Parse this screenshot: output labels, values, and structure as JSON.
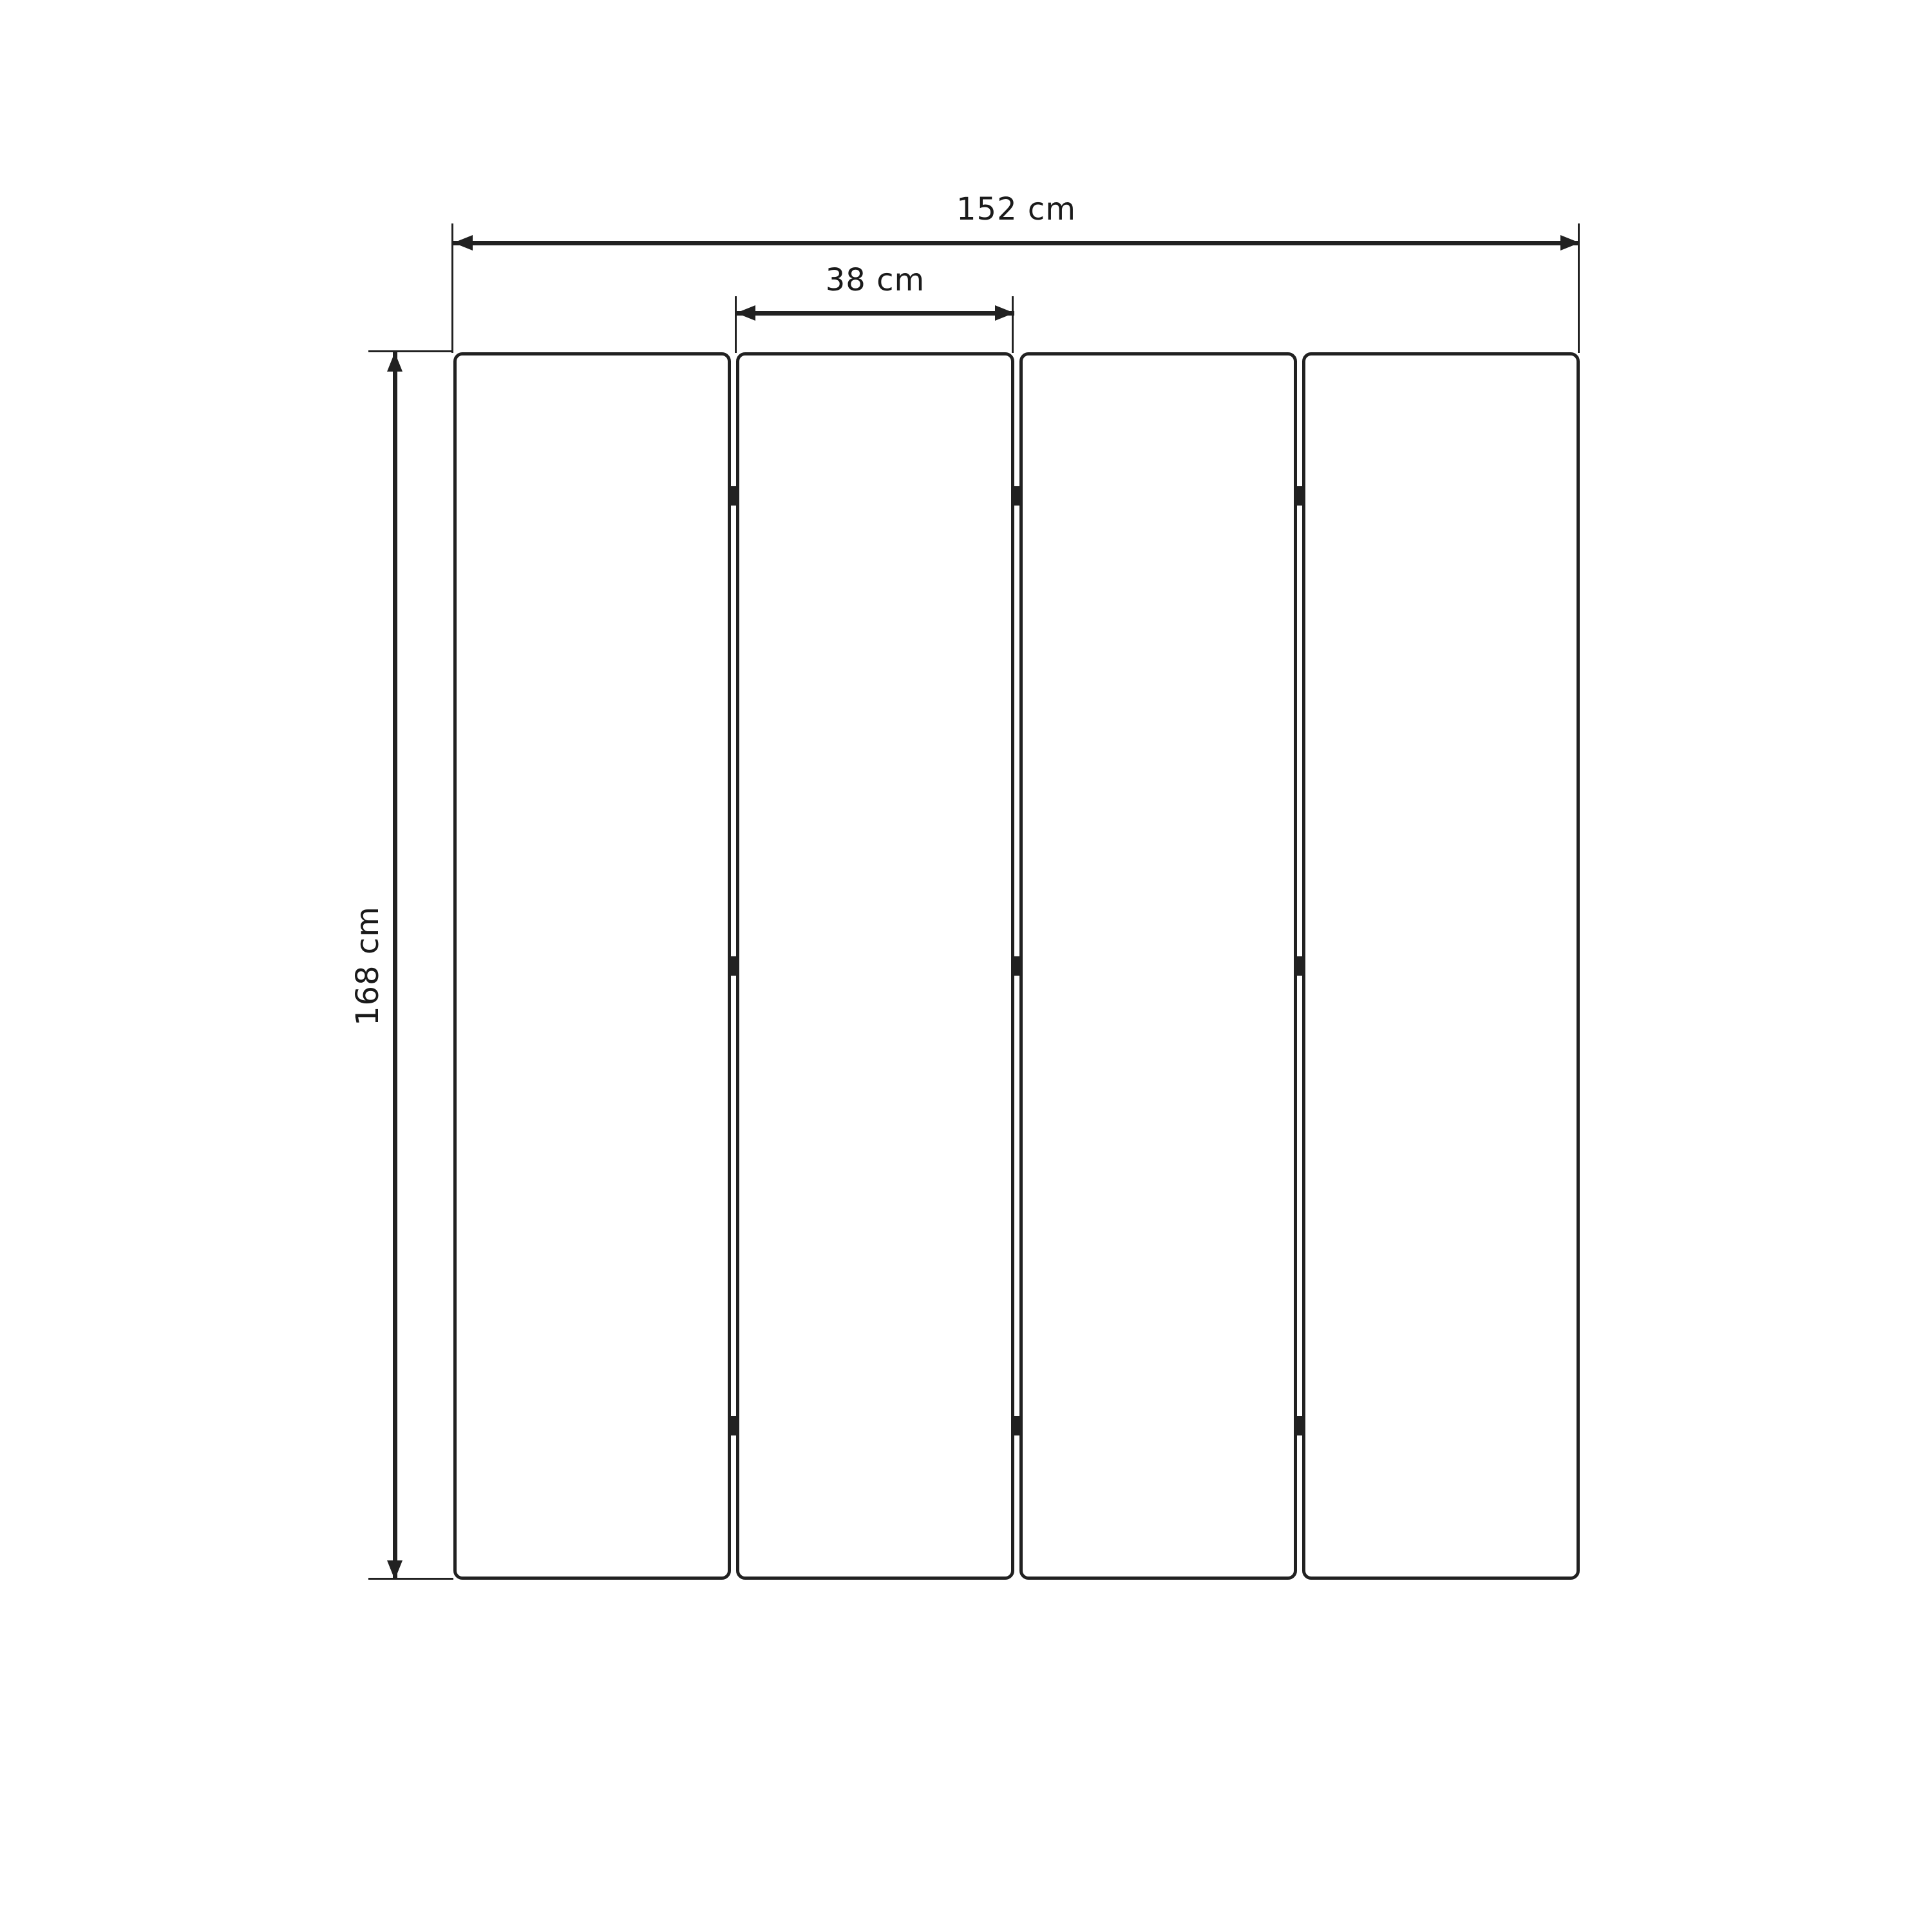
{
  "diagram": {
    "panel_count": 4,
    "hinge_rows_per_gap": 3,
    "dimensions": {
      "total_width_label": "152 cm",
      "panel_width_label": "38 cm",
      "height_label": "168 cm"
    },
    "colors": {
      "line": "#212121",
      "background": "#ffffff",
      "text": "#1a1a1a"
    }
  }
}
